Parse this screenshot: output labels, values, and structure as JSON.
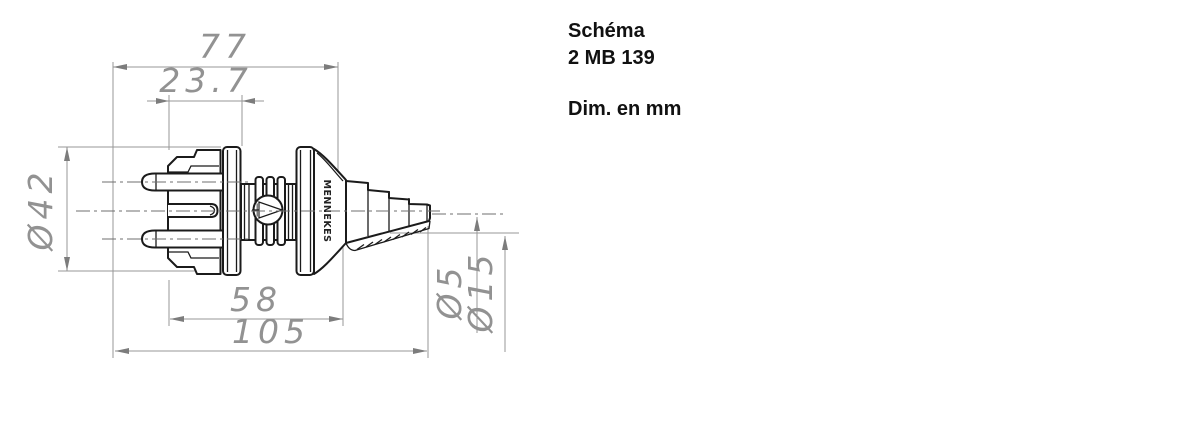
{
  "header": {
    "title_line1": "Schéma",
    "title_line2": "2 MB 139",
    "units_label": "Dim. en mm"
  },
  "drawing": {
    "brand_marking": "MENNEKES",
    "dimensions": {
      "overall_length": "105",
      "length_with_pins": "77",
      "body_length": "58",
      "front_length": "23.7",
      "body_diameter": "Ø42",
      "cable_dia_min": "Ø5",
      "cable_dia_max": "Ø15"
    }
  }
}
